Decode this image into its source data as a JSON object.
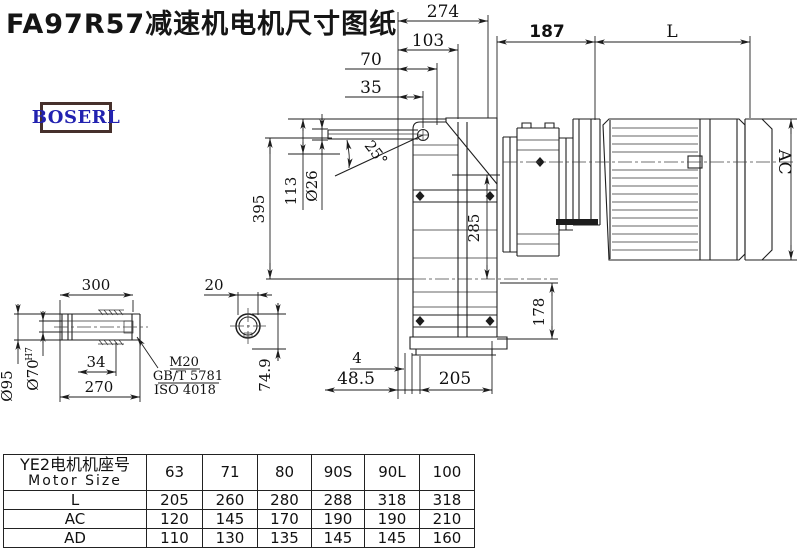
{
  "title": "FA97R57减速机电机尺寸图纸",
  "brand": "BOSERL",
  "dims": {
    "d274": "274",
    "d103": "103",
    "d70": "70",
    "d35": "35",
    "d187": "187",
    "L": "L",
    "AC": "AC",
    "d395": "395",
    "d113": "113",
    "dia26": "Ø26",
    "angle": "25°",
    "d285": "285",
    "d178": "178",
    "d4": "4",
    "d48p5": "48.5",
    "d205": "205",
    "d300": "300",
    "dia95": "Ø95",
    "dia70": "Ø70",
    "tol": "H7",
    "d34": "34",
    "d270": "270",
    "thread": "M20",
    "std1": "GB/T 5781",
    "std2": "ISO 4018",
    "d20": "20",
    "d74p9": "74.9"
  },
  "table": {
    "header_cn": "YE2电机机座号",
    "header_en": "Motor Size",
    "cols": [
      "63",
      "71",
      "80",
      "90S",
      "90L",
      "100"
    ],
    "rows": [
      {
        "label": "L",
        "values": [
          "205",
          "260",
          "280",
          "288",
          "318",
          "318"
        ]
      },
      {
        "label": "AC",
        "values": [
          "120",
          "145",
          "170",
          "190",
          "190",
          "210"
        ]
      },
      {
        "label": "AD",
        "values": [
          "110",
          "130",
          "135",
          "145",
          "145",
          "160"
        ]
      }
    ]
  }
}
